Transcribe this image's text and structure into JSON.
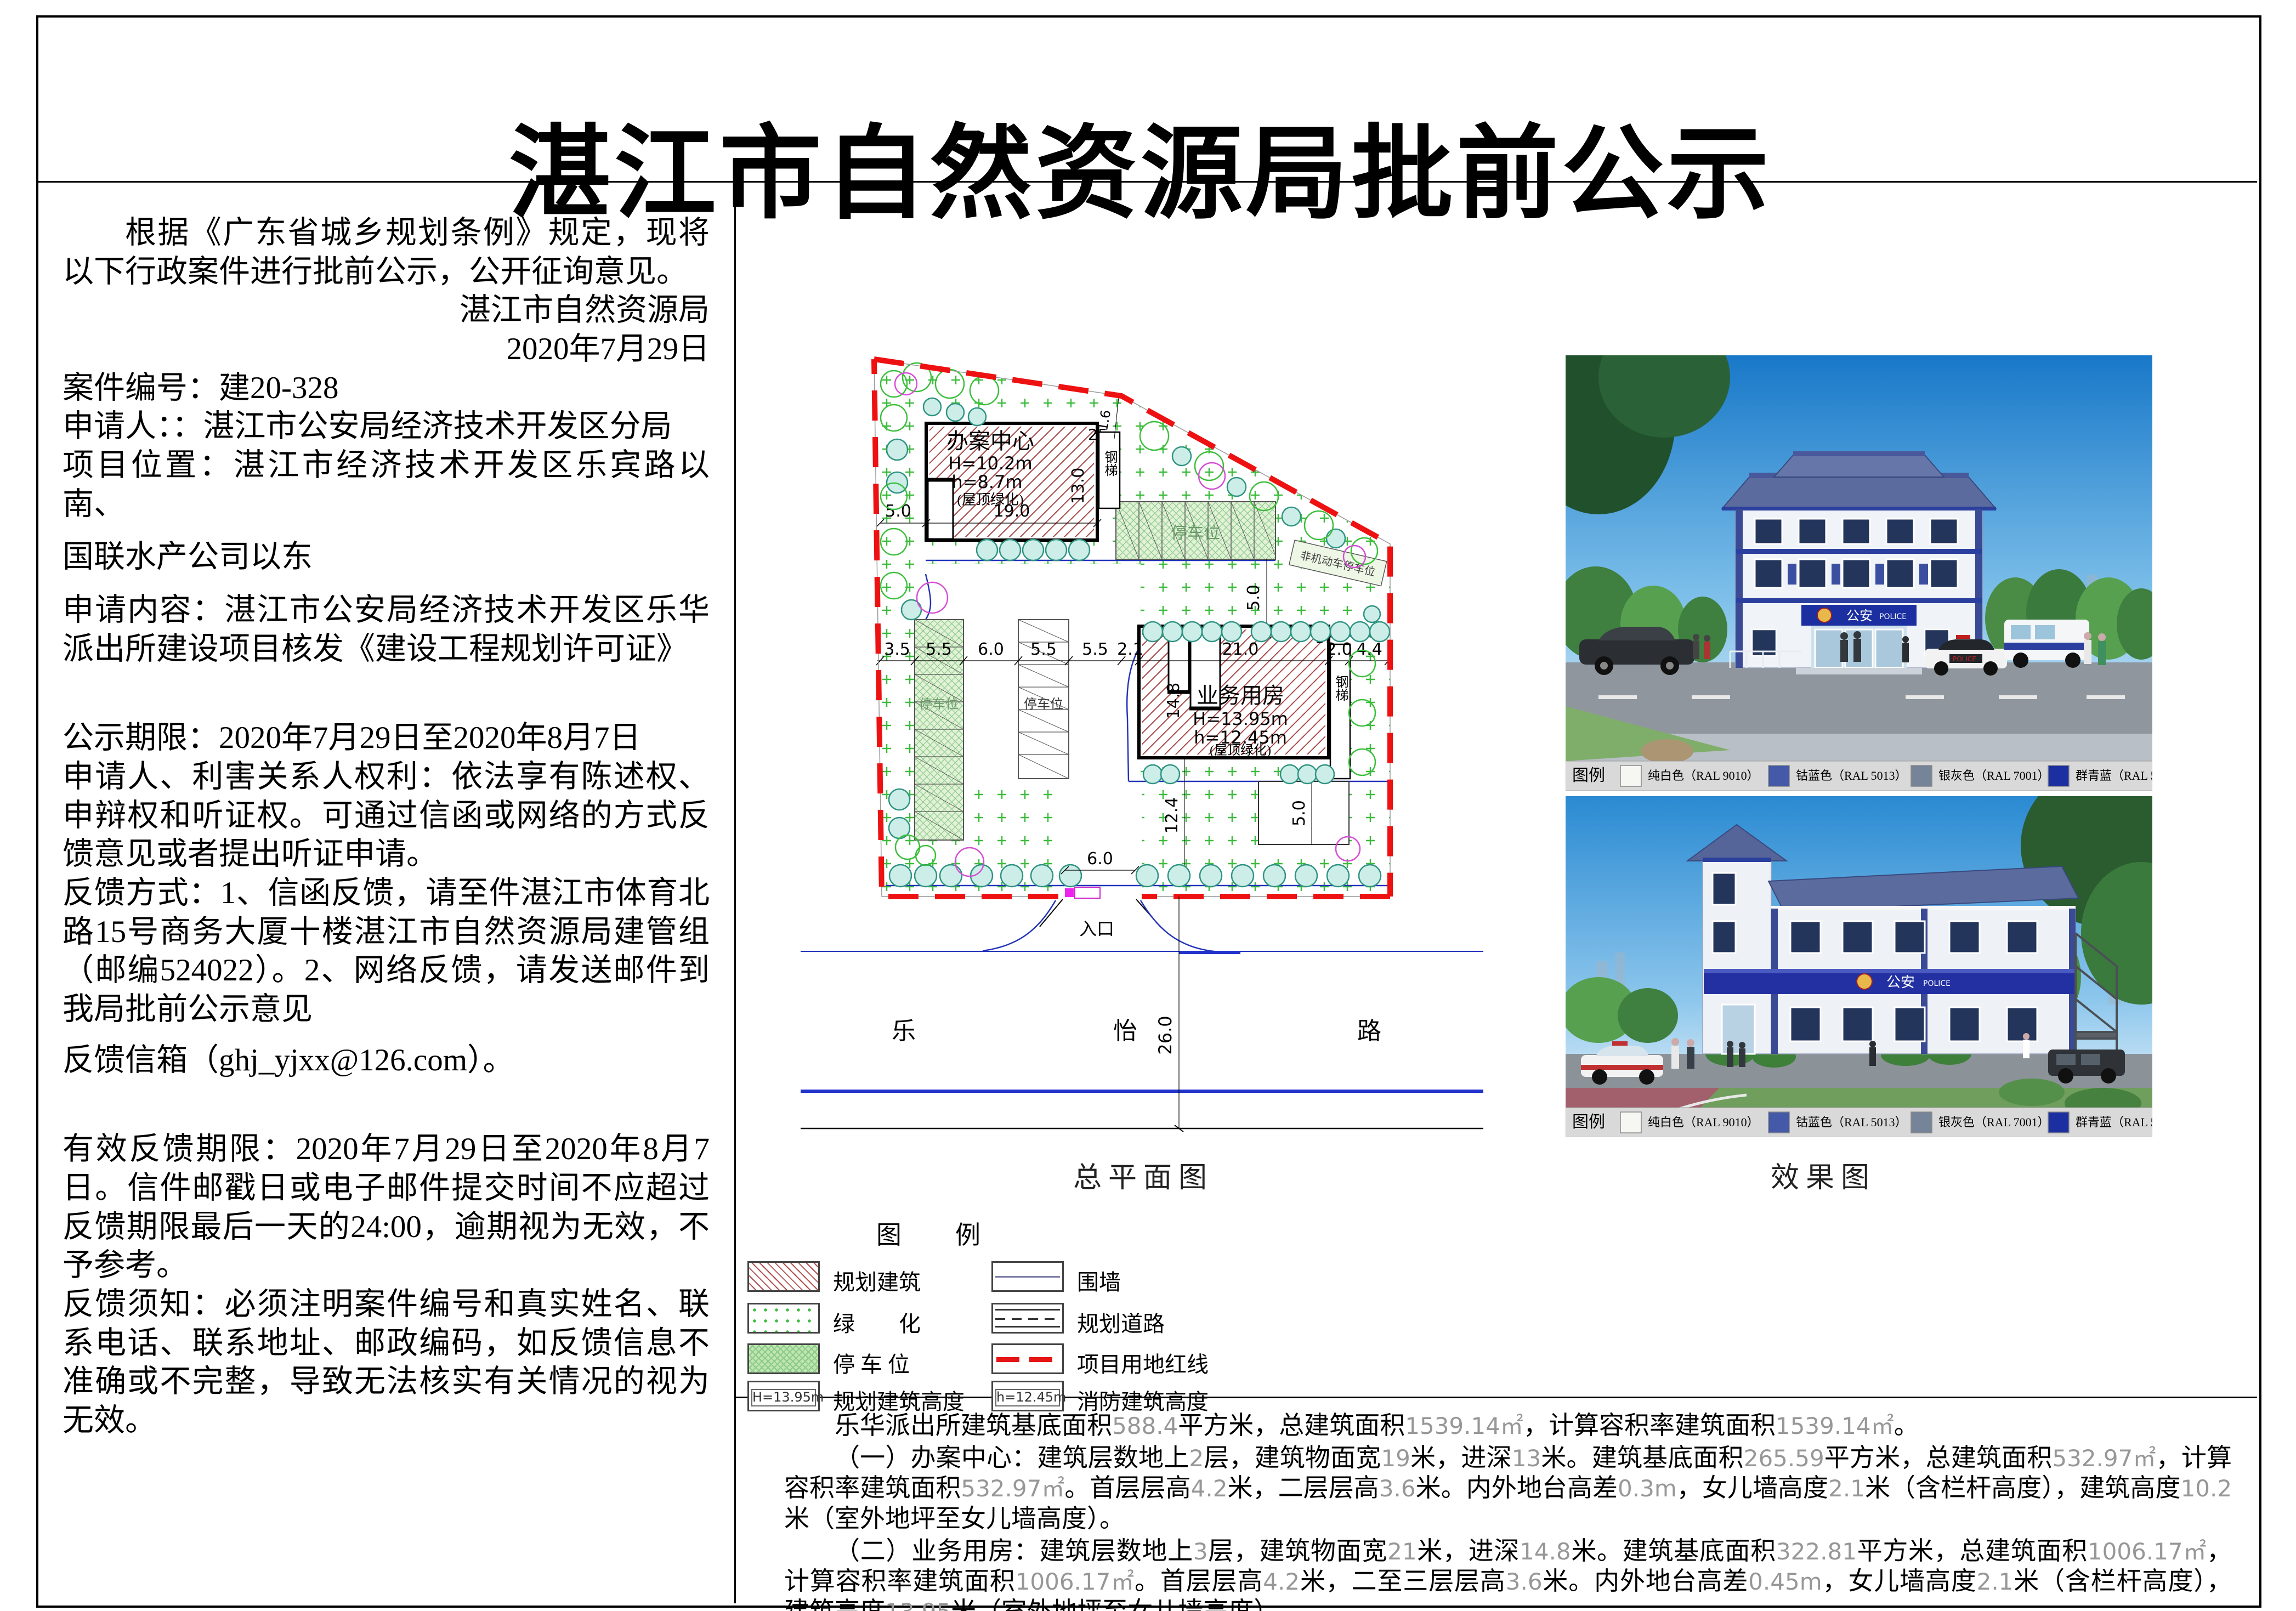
{
  "title": "湛江市自然资源局批前公示",
  "left_panel": {
    "paragraphs": [
      {
        "text": "根据《广东省城乡规划条例》规定，现将以下行政案件进行批前公示，公开征询意见。"
      },
      {
        "text": "湛江市自然资源局"
      },
      {
        "text": "2020年7月29日"
      },
      {
        "text": "案件编号：建20-328"
      },
      {
        "text": "申请人：：湛江市公安局经济技术开发区分局"
      },
      {
        "text": "项目位置：湛江市经济技术开发区乐宾路以南、"
      },
      {
        "text": "国联水产公司以东"
      },
      {
        "text": "申请内容：湛江市公安局经济技术开发区乐华派出所建设项目核发《建设工程规划许可证》"
      },
      {
        "text": "公示期限：2020年7月29日至2020年8月7日"
      },
      {
        "text": "申请人、利害关系人权利：依法享有陈述权、申辩权和听证权。可通过信函或网络的方式反馈意见或者提出听证申请。"
      },
      {
        "text": "反馈方式：1、信函反馈，请至件湛江市体育北路15号商务大厦十楼湛江市自然资源局建管组（邮编524022）。2、网络反馈，请发送邮件到我局批前公示意见"
      },
      {
        "text": "反馈信箱（ghj_yjxx@126.com）。"
      },
      {
        "text": "有效反馈期限：2020年7月29日至2020年8月7日。信件邮戳日或电子邮件提交时间不应超过反馈期限最后一天的24:00，逾期视为无效，不予参考。"
      },
      {
        "text": "反馈须知：必须注明案件编号和真实姓名、联系电话、联系地址、邮政编码，如反馈信息不准确或不完整，导致无法核实有关情况的视为无效。"
      }
    ]
  },
  "siteplan": {
    "caption": "总平面图",
    "building1": {
      "name": "办案中心",
      "H": "H=10.2m",
      "h": "h=8.7m",
      "roof": "(屋顶绿化)",
      "floor": "2F",
      "dim_width": "19.0",
      "dim_depth": "13.0",
      "dim_left": "5.0"
    },
    "building2": {
      "name": "业务用房",
      "H": "H=13.95m",
      "h": "h=12.45m",
      "roof": "(屋顶绿化)",
      "floor": "3F",
      "dim_width": "21.0",
      "dim_depth": "14.8",
      "dim_below": "12.4",
      "dim_below_right": "5.0"
    },
    "stair_label": "钢梯",
    "parking_label": "停车位",
    "nonmotor_label": "非机动车停车位",
    "dim_row": [
      "3.5",
      "5.5",
      "6.0",
      "5.5",
      "5.5",
      "2.1",
      "21.0",
      "2.0",
      "4.4"
    ],
    "dim_top_right": "5.0",
    "dim_gap": "1.6",
    "entrance_label": "入口",
    "entrance_dim": "6.0",
    "road_name": [
      "乐",
      "怡",
      "路"
    ],
    "road_width": "26.0"
  },
  "site_legend": {
    "title": "图　例",
    "items_left": [
      {
        "label": "规划建筑"
      },
      {
        "label": "绿　　化"
      },
      {
        "label": "停 车 位"
      },
      {
        "label": "规划建筑高度",
        "value": "H=13.95m"
      }
    ],
    "items_right": [
      {
        "label": "围墙"
      },
      {
        "label": "规划道路"
      },
      {
        "label": "项目用地红线"
      },
      {
        "label": "消防建筑高度",
        "value": "h=12.45m"
      }
    ]
  },
  "renderings": {
    "caption": "效果图",
    "sign_cn": "公安",
    "sign_en": "POLICE",
    "legend_title": "图例",
    "colors": [
      {
        "label": "纯白色（RAL 9010）",
        "hex": "#f6f6f2"
      },
      {
        "label": "钴蓝色（RAL 5013）",
        "hex": "#4459a8"
      },
      {
        "label": "银灰色（RAL 7001）",
        "hex": "#76849a"
      },
      {
        "label": "群青蓝（RAL 5002）",
        "hex": "#1b2fa0"
      }
    ]
  },
  "bottom_text": {
    "paragraphs": [
      {
        "text": "乐华派出所建筑基底面积588.4平方米，总建筑面积1539.14㎡，计算容积率建筑面积1539.14㎡。"
      },
      {
        "text": "（一）办案中心：建筑层数地上2层，建筑物面宽19米，进深13米。建筑基底面积265.59平方米，总建筑面积532.97㎡，计算容积率建筑面积532.97㎡。首层层高4.2米，二层层高3.6米。内外地台高差0.3m，女儿墙高度2.1米（含栏杆高度），建筑高度10.2米（室外地坪至女儿墙高度）。"
      },
      {
        "text": "（二）业务用房：建筑层数地上3层，建筑物面宽21米，进深14.8米。建筑基底面积322.81平方米，总建筑面积1006.17㎡，计算容积率建筑面积1006.17㎡。首层层高4.2米，二至三层层高3.6米。内外地台高差0.45m，女儿墙高度2.1米（含栏杆高度），建筑高度13.95米（室外地坪至女儿墙高度）。"
      }
    ]
  }
}
